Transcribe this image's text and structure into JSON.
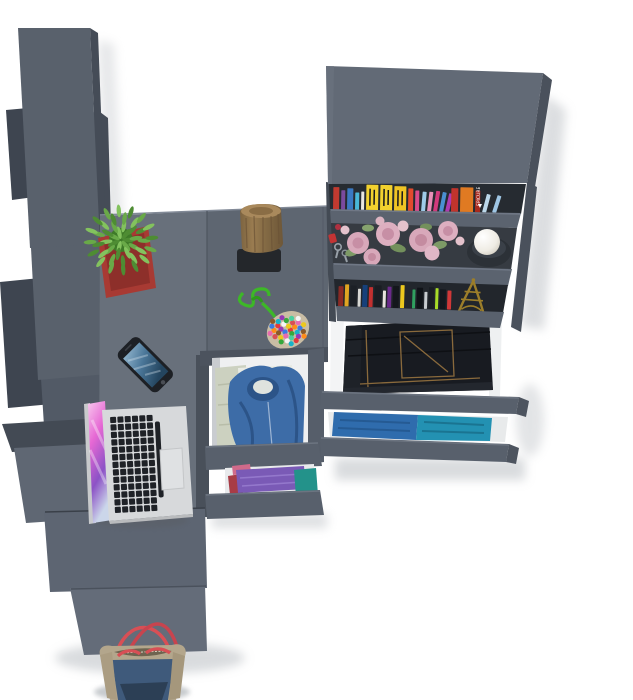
{
  "scene": {
    "description": "Top-down 3D render of a graphite-grey teen room furniture set: corner desk with laptop, smartphone, cactus, log stool and bead pouch; tall wardrobe panels on the left; bookshelf on the right with two rows of books, a rose garland, keys, a ball candle and an Eiffel tower figurine; pulled-out drawers holding folded jeans, denim shirts, a hoodie and folded tees; a denim tote bag at the bottom cabinet",
    "background": "#ffffff",
    "furniture_finish": "graphite grey"
  },
  "objects": [
    "wardrobe-panels",
    "corner-desk",
    "laptop",
    "smartphone",
    "cactus-plant",
    "log-stool",
    "bead-pouch",
    "bookshelf",
    "flower-garland",
    "keys",
    "ball-candle",
    "eiffel-figurine",
    "jeans-drawer",
    "shirts-drawer",
    "hoodie-drawer",
    "folded-clothes-drawer",
    "base-cabinet",
    "tote-bag"
  ],
  "palette": {
    "bg": "#ffffff",
    "wardrobe_front": "#59616c",
    "wardrobe_mid": "#525a66",
    "wardrobe_dark": "#3e4550",
    "wardrobe_edge": "#454c57",
    "wardrobe_step_light": "#5f6773",
    "desk_left": "#68707b",
    "desk_right": "#5e6671",
    "divider_dark": "#49505a",
    "cabinet_upper": "#5d6572",
    "cabinet_lower": "#646c79",
    "shelf_top": "#626a76",
    "shelf_side": "#4a515c",
    "shelf_lip": "#5b636f",
    "shelf_bg_dark": "#262b31",
    "shelf_bg_mid": "#363b42",
    "drawer_front": "#58606c",
    "drawer_interior": "#eff0f1",
    "rail_white": "#f3f4f5",
    "jeans": "#181b21",
    "jeans_stitch": "#8a6a3c",
    "hoodie_blue": "#3d6ca7",
    "shirt_khaki": "#ccd1c0",
    "tee_white": "#e9ebe4",
    "cloth_purple": "#7a5ab6",
    "cloth_teal": "#23928a",
    "cloth_red": "#a83c46",
    "cloth_pink": "#d06a8a",
    "denim_drawer": "#2f6cad",
    "teal_drawer": "#2391b2",
    "pot_red": "#a83a33",
    "cactus_green": "#4e8c33",
    "log_wood": "#8f7148",
    "log_mat": "#24272b",
    "cord_green": "#3db827",
    "laptop_silver": "#d7d9db",
    "laptop_key": "#1f2227",
    "phone_body": "#1d2025",
    "flower_pink": "#d8a8ba",
    "flower_deep": "#c78fa5",
    "leaf_green": "#7d9a66",
    "candle_holder": "#2c3137",
    "eiffel_gold": "#9c7e2a",
    "bag_khaki": "#b3a68c",
    "bag_denim": "#3f5a7b",
    "bag_navy": "#2c3f55",
    "bag_handle_red": "#d84f55"
  },
  "bookshelf": {
    "orange_book_label": "EPICURE",
    "top_shelf_books": [
      {
        "c": "#c13a30",
        "w": 6,
        "h": 23
      },
      {
        "c": "#7a4a9e",
        "w": 4,
        "h": 20
      },
      {
        "c": "#3a79c2",
        "w": 6,
        "h": 22
      },
      {
        "c": "#49b8d8",
        "w": 4,
        "h": 18
      },
      {
        "c": "#e8e6e0",
        "w": 3,
        "h": 19
      },
      {
        "c": "#f2d12e",
        "w": 12,
        "h": 26,
        "marks": 1
      },
      {
        "c": "#f2d12e",
        "w": 12,
        "h": 26,
        "marks": 1
      },
      {
        "c": "#efc424",
        "w": 12,
        "h": 25,
        "marks": 1
      },
      {
        "c": "#e24a2e",
        "w": 5,
        "h": 23
      },
      {
        "c": "#d94a8c",
        "w": 4,
        "h": 21
      },
      {
        "c": "#9ecbe8",
        "w": 4,
        "h": 20,
        "lean": 4
      },
      {
        "c": "#e890b8",
        "w": 4,
        "h": 20,
        "lean": 6
      },
      {
        "c": "#d23a7c",
        "w": 4,
        "h": 21,
        "lean": 8
      },
      {
        "c": "#4a90d2",
        "w": 4,
        "h": 20,
        "lean": 10
      },
      {
        "c": "#b03ab0",
        "w": 4,
        "h": 19,
        "lean": 12
      },
      {
        "c": "#c1342c",
        "w": 7,
        "h": 24
      },
      {
        "c": "#e07a22",
        "w": 13,
        "h": 25,
        "label": 1
      },
      {
        "c": "#a8291e",
        "w": 5,
        "h": 22
      },
      {
        "c": "#bcd8ea",
        "w": 4,
        "h": 19,
        "lean": 14,
        "gap": 6
      },
      {
        "c": "#9fc6e4",
        "w": 4,
        "h": 18,
        "lean": 17
      }
    ],
    "lower_shelf_books": [
      {
        "c": "#8a2a24",
        "w": 5,
        "h": 20,
        "gap": 1.5
      },
      {
        "c": "#e0a422",
        "w": 4,
        "h": 22,
        "gap": 1.5
      },
      {
        "c": "#1c2026",
        "w": 6,
        "h": 21,
        "gap": 1.5
      },
      {
        "c": "#d8d8d4",
        "w": 3,
        "h": 18,
        "gap": 1.5
      },
      {
        "c": "#16407a",
        "w": 5,
        "h": 22,
        "gap": 1.5
      },
      {
        "c": "#c23030",
        "w": 4,
        "h": 20,
        "gap": 1.5
      },
      {
        "c": "#1a1d23",
        "w": 7,
        "h": 22,
        "gap": 1.5
      },
      {
        "c": "#e8e4de",
        "w": 3,
        "h": 17,
        "gap": 1.5
      },
      {
        "c": "#6a2a8a",
        "w": 4,
        "h": 21,
        "gap": 1.5
      },
      {
        "c": "#14171c",
        "w": 6,
        "h": 22,
        "gap": 1.5
      },
      {
        "c": "#ecc81e",
        "w": 4,
        "h": 23,
        "gap": 1.5
      },
      {
        "c": "#22262c",
        "w": 5,
        "h": 20,
        "gap": 1.5
      },
      {
        "c": "#30a060",
        "w": 3,
        "h": 19,
        "gap": 1.5
      },
      {
        "c": "#101318",
        "w": 6,
        "h": 21,
        "gap": 1.5
      },
      {
        "c": "#c8ccd0",
        "w": 3,
        "h": 17,
        "gap": 1.5
      },
      {
        "c": "#1a1e24",
        "w": 5,
        "h": 22,
        "gap": 1.5
      },
      {
        "c": "#a8dc28",
        "w": 3,
        "h": 21,
        "gap": 1.5
      },
      {
        "c": "#14181e",
        "w": 6,
        "h": 20,
        "gap": 1.5
      },
      {
        "c": "#d03838",
        "w": 4,
        "h": 19,
        "gap": 1.5
      }
    ]
  },
  "bead_colors": [
    "#e23b3b",
    "#3b7be2",
    "#ecc81e",
    "#35a83c",
    "#9638b8",
    "#ff8c1a",
    "#e86ab0",
    "#f5f5f5",
    "#19b2c8",
    "#8a5a2a",
    "#d84f55",
    "#4ad0a0"
  ],
  "drawers": {
    "narrow_top": "denim hoodie with white tee and khaki shirt",
    "narrow_bottom": "folded purple, teal, red and pink tees",
    "wide_top": "folded dark jeans",
    "wide_bottom": "blue denim and teal shirts"
  },
  "bag_contents": "denim tote bag with khaki trim and red handles"
}
